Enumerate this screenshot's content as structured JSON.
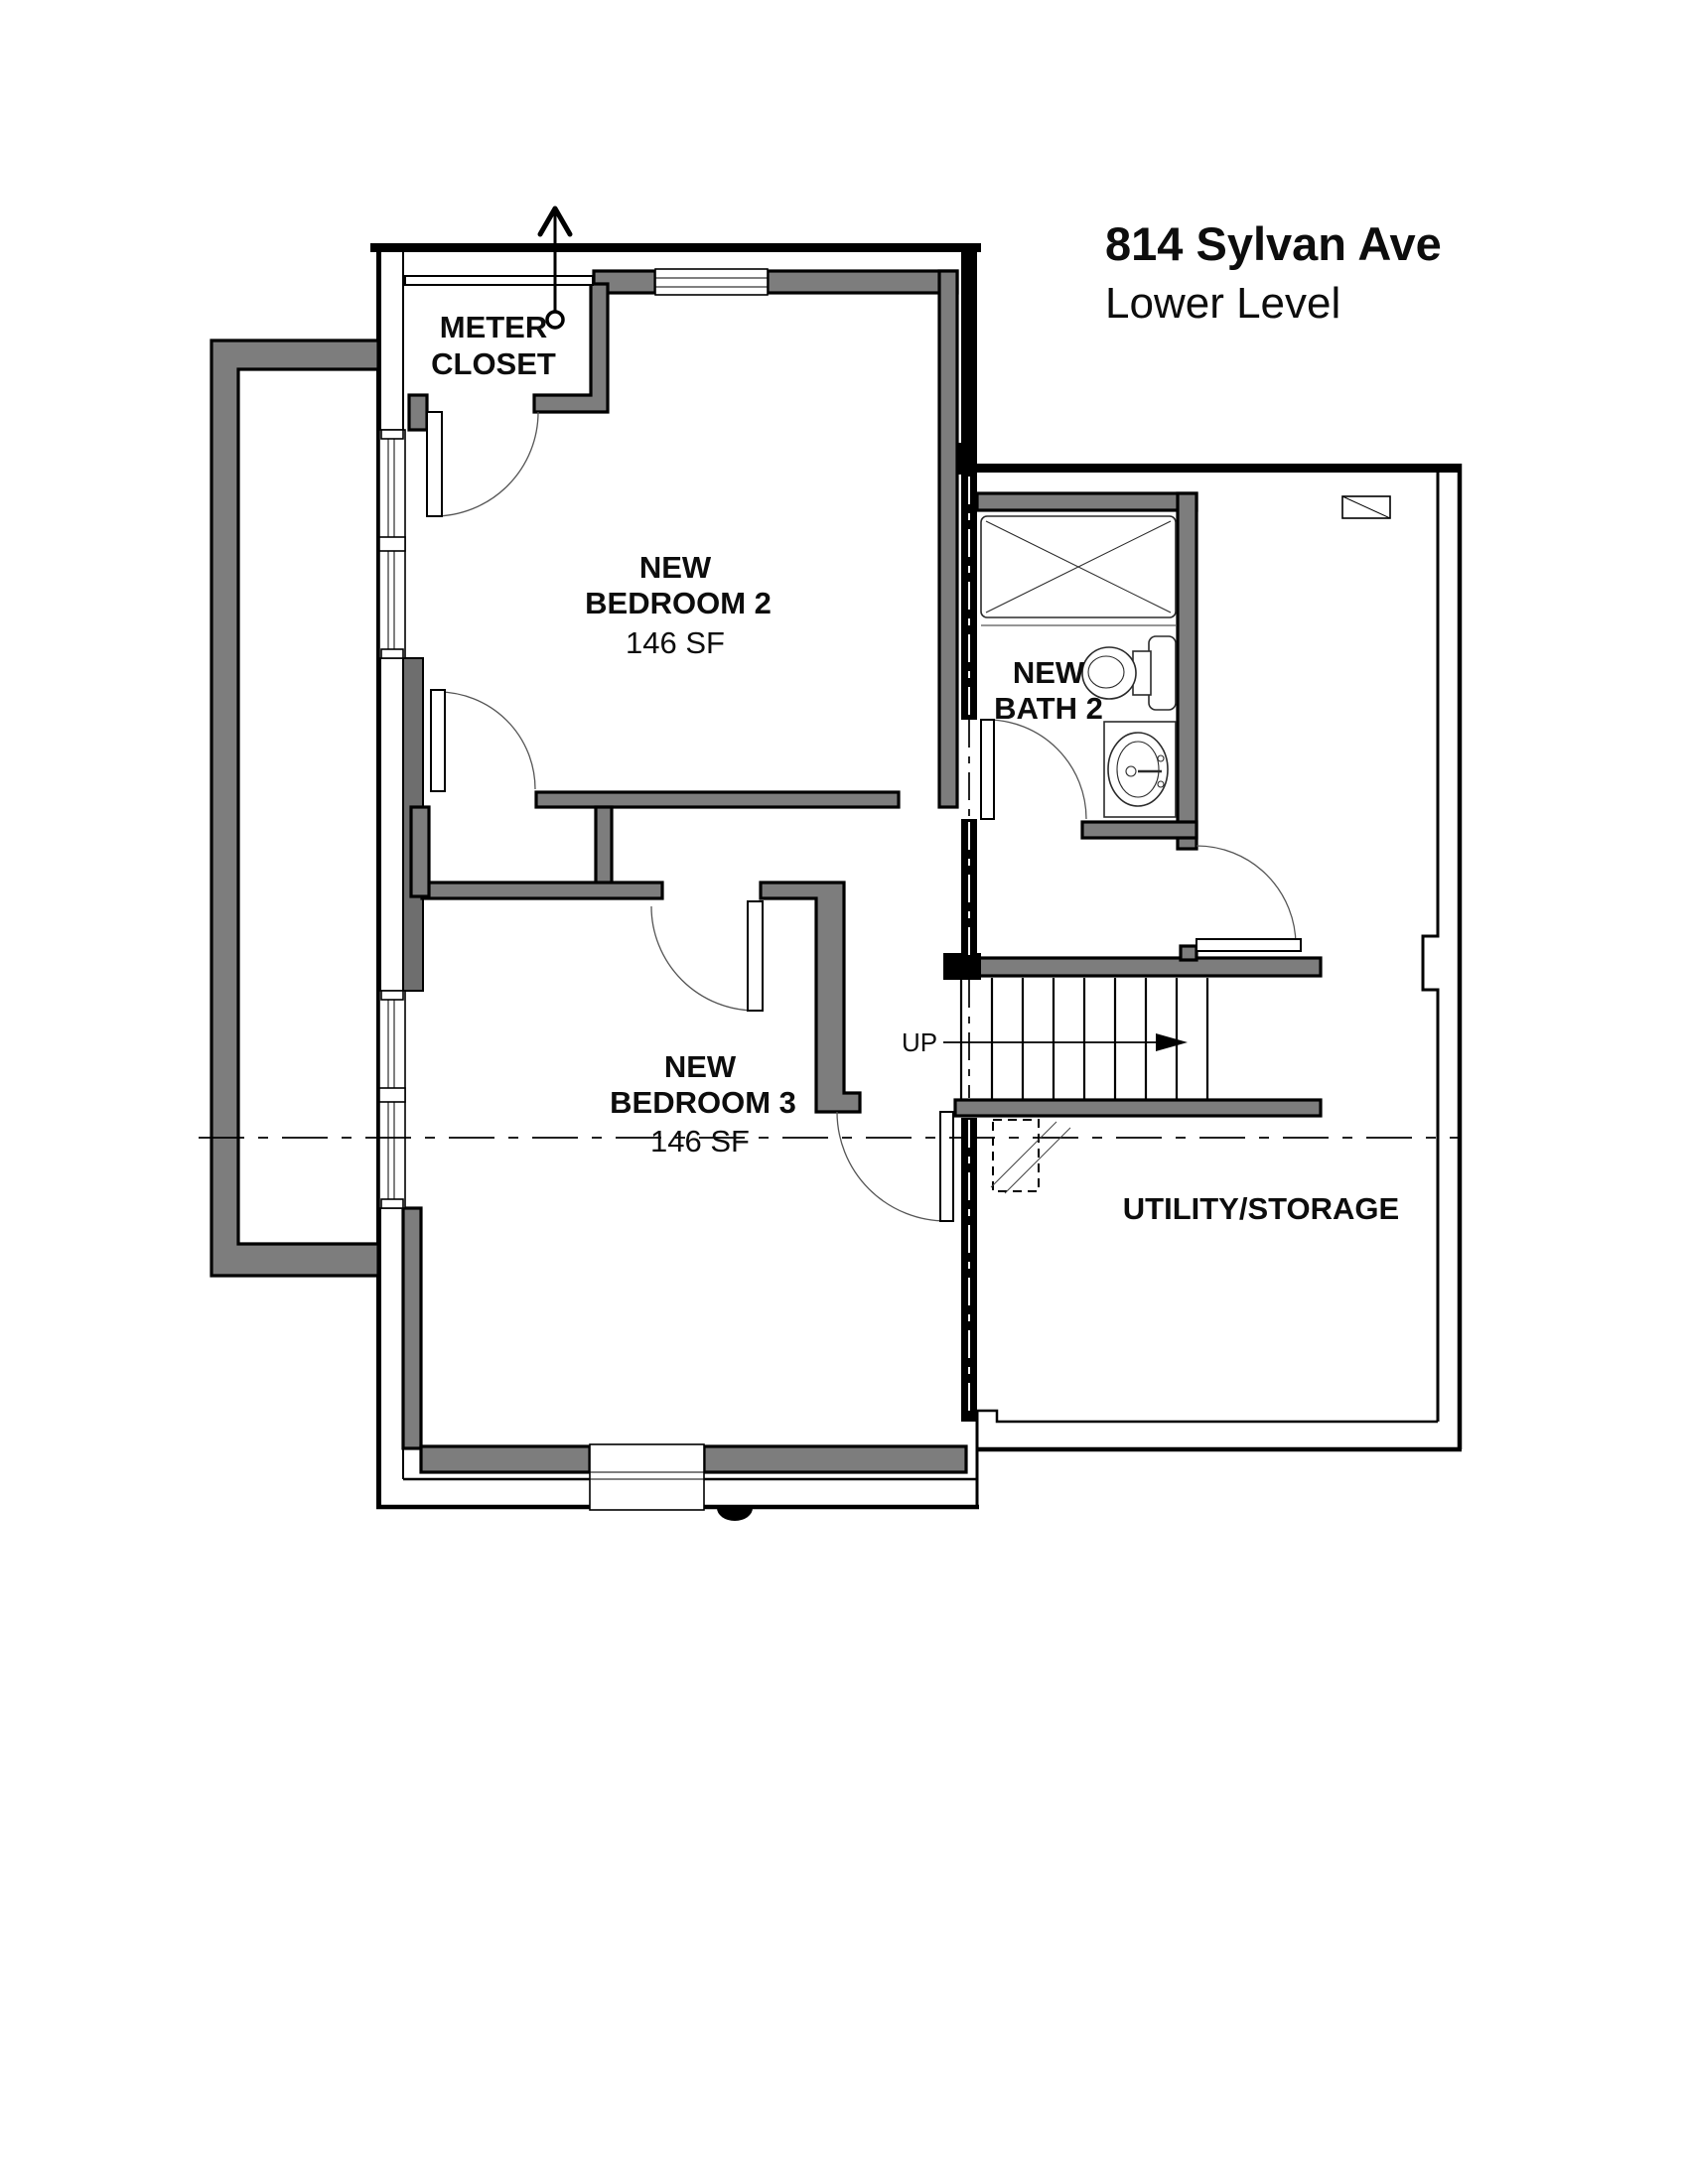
{
  "title": {
    "address": "814 Sylvan Ave",
    "level": "Lower Level"
  },
  "rooms": {
    "meter_closet": {
      "line1": "METER",
      "line2": "CLOSET"
    },
    "bedroom2": {
      "line1": "NEW",
      "line2": "BEDROOM 2",
      "area": "146 SF"
    },
    "bath2": {
      "line1": "NEW",
      "line2": "BATH 2"
    },
    "bedroom3": {
      "line1": "NEW",
      "line2": "BEDROOM 3",
      "area": "146 SF"
    },
    "utility": {
      "label": "UTILITY/STORAGE"
    }
  },
  "stairs": {
    "direction_label": "UP"
  },
  "colors": {
    "background": "#ffffff",
    "new_wall_fill": "#7d7d7d",
    "existing_wall": "#000000",
    "centerline": "#000000"
  }
}
